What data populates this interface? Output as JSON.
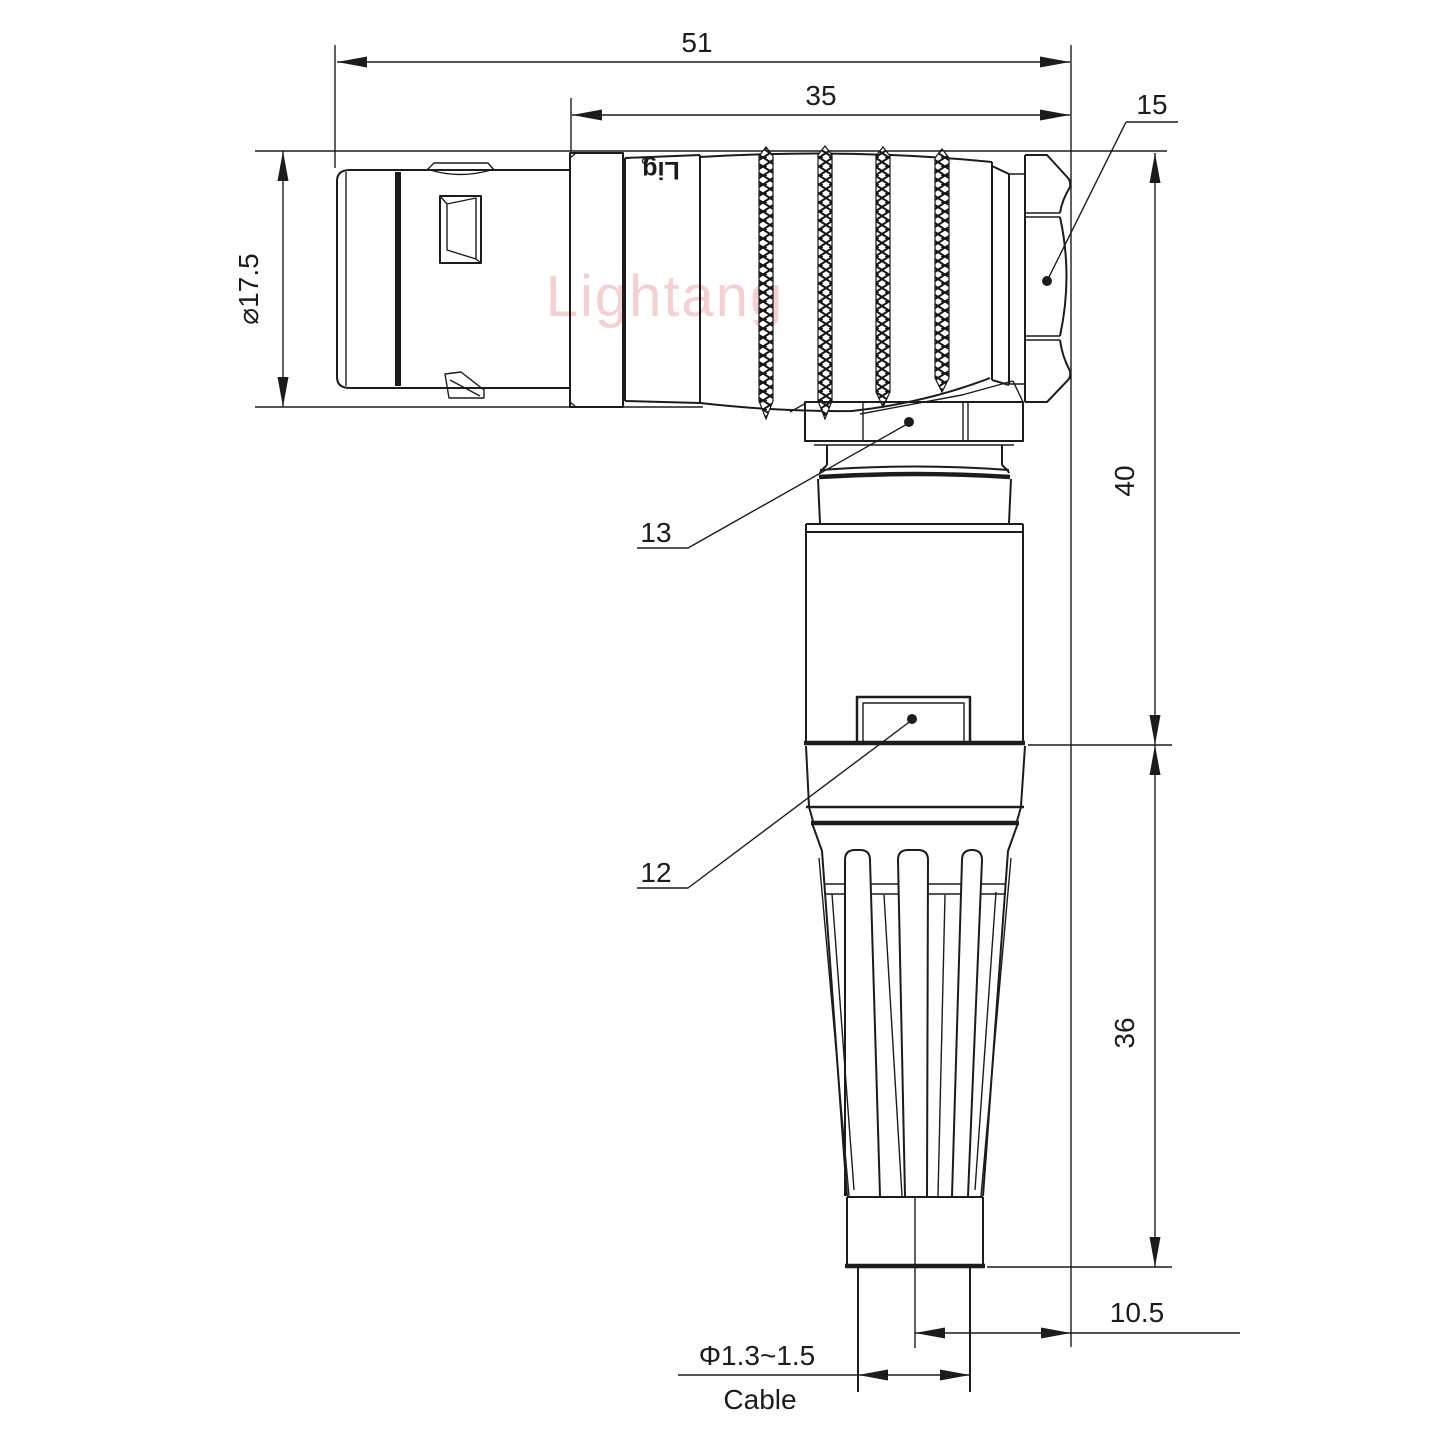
{
  "title": "Right-angle connector technical drawing",
  "watermark": "Lightang",
  "brand_mark": "Lig",
  "dims": {
    "overall_length": "51",
    "rear_length": "35",
    "hex_callout": "15",
    "front_diameter": "⌀17.5",
    "height_upper": "40",
    "height_lower": "36",
    "cable_offset": "10.5",
    "cable_range": "Φ1.3~1.5",
    "cable_label": "Cable",
    "part_collar": "13",
    "part_body": "12"
  },
  "colors": {
    "line": "#1c1c1c",
    "watermark": "#edaaaa",
    "background": "#ffffff"
  }
}
